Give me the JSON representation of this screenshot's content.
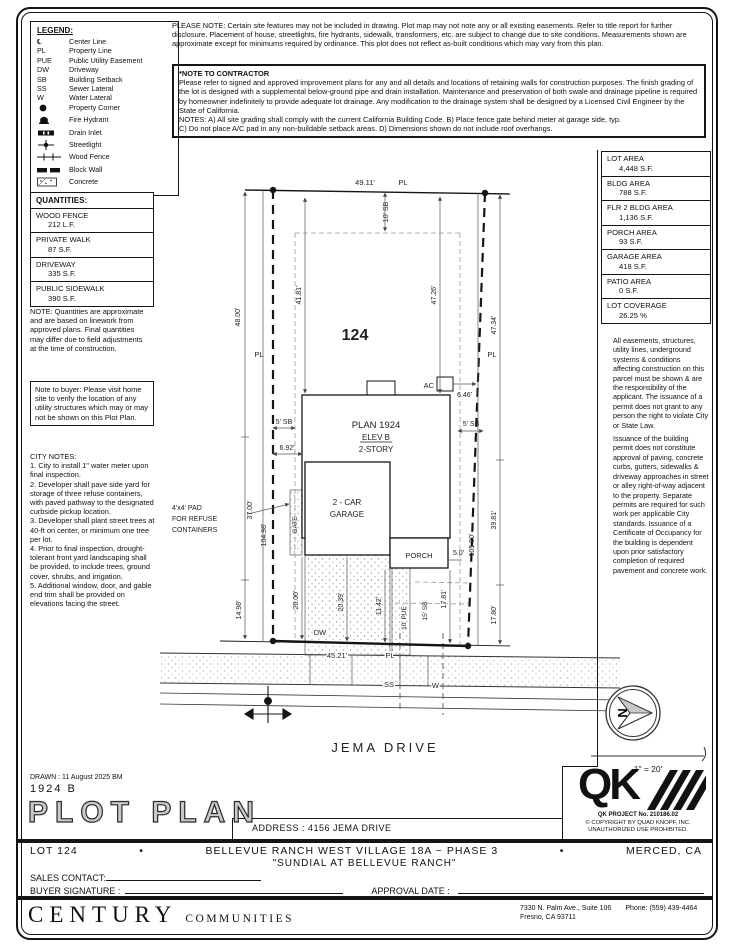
{
  "header": {
    "please_note": "PLEASE NOTE:  Certain site features may not be included in drawing. Plot map may not note any or all existing easements. Refer to title report for further disclosure. Placement of house, streetlights, fire hydrants, sidewalk, transformers, etc. are subject to change due to site conditions. Measurements shown are approximate except for minimums required by ordinance. This plot does not reflect as-built conditions which may vary from this plan.",
    "contractor_title": "*NOTE TO CONTRACTOR",
    "contractor_body": "Please refer to signed and approved improvement plans for any and all details and locations of retaining walls for construction purposes. The finish grading of the lot is designed with a supplemental below-ground pipe and drain installation. Maintenance and preservation of both swale and drainage pipeline is required by homeowner indefinitely to provide adequate lot drainage. Any modification to the drainage system shall be designed by a Licensed Civil Engineer by the State of California.\nNOTES:  A) All site grading shall comply with the current California Building Code.  B) Place fence gate behind meter at garage side, typ.\nC) Do not place A/C pad in any non-buildable setback areas.  D) Dimensions shown do not include roof overhangs."
  },
  "legend": {
    "title": "LEGEND:",
    "items": [
      {
        "sym": "℄",
        "label": "Center Line"
      },
      {
        "sym": "PL",
        "label": "Property Line"
      },
      {
        "sym": "PUE",
        "label": "Public Utility Easement"
      },
      {
        "sym": "DW",
        "label": "Driveway"
      },
      {
        "sym": "SB",
        "label": "Building Setback"
      },
      {
        "sym": "SS",
        "label": "Sewer Lateral"
      },
      {
        "sym": "W",
        "label": "Water Lateral"
      },
      {
        "icon": "property-corner",
        "label": "Property Corner"
      },
      {
        "icon": "fire-hydrant",
        "label": "Fire Hydrant"
      },
      {
        "icon": "drain-inlet",
        "label": "Drain Inlet"
      },
      {
        "icon": "streetlight",
        "label": "Streetlight"
      },
      {
        "icon": "wood-fence",
        "label": "Wood Fence"
      },
      {
        "icon": "block-wall",
        "label": "Block Wall"
      },
      {
        "icon": "concrete",
        "label": "Concrete"
      }
    ]
  },
  "quantities": {
    "title": "QUANTITIES:",
    "items": [
      {
        "label": "WOOD FENCE",
        "value": "212 L.F."
      },
      {
        "label": "PRIVATE WALK",
        "value": "87 S.F."
      },
      {
        "label": "DRIVEWAY",
        "value": "335 S.F."
      },
      {
        "label": "PUBLIC SIDEWALK",
        "value": "390 S.F."
      }
    ],
    "note": "NOTE: Quantities are approximate and are based on linework from approved plans.  Final quantities may differ due to field adjustments at the time of construction."
  },
  "buyer_note": "Note to buyer: Please visit home site to verify the location of any utility structures which may or may not be shown on this Plot Plan.",
  "city_notes": {
    "title": "CITY NOTES:",
    "body": "1. City to install 1\" water meter upon final inspection.\n2. Developer shall pave side yard for storage of three refuse containers, with paved pathway to the designated curbside pickup location.\n3. Developer shall plant street trees at 40-ft on center, or minimum one tree per lot.\n4. Prior to final inspection, drought-tolerant front yard landscaping shall be provided, to include trees, ground cover, shrubs, and irrigation.\n5. Additional window, door, and gable end trim shall be provided on elevations facing the street."
  },
  "areas": {
    "items": [
      {
        "label": "LOT AREA",
        "value": "4,448 S.F."
      },
      {
        "label": "BLDG AREA",
        "value": "788 S.F."
      },
      {
        "label": "FLR 2 BLDG AREA",
        "value": "1,136 S.F."
      },
      {
        "label": "PORCH AREA",
        "value": "93 S.F."
      },
      {
        "label": "GARAGE AREA",
        "value": "418 S.F."
      },
      {
        "label": "PATIO AREA",
        "value": "0 S.F."
      },
      {
        "label": "LOT COVERAGE",
        "value": "26.25 %"
      }
    ]
  },
  "side_notes": {
    "para1": "All easements, structures, utility lines, underground systems & conditions affecting construction on this parcel must be shown & are the responsibility of the applicant. The issuance of a permit does not grant to any person the right to violate City or State Law.",
    "para2": "Issuance of the building permit does not constitute approval of paving, concrete curbs, gutters, sidewalks & driveway approaches in street or alley right-of-way adjacent to the property. Separate permits are required for such work per applicable City standards. Issuance of a Certificate of Occupancy for the building is dependent upon prior satisfactory completion of required pavement and concrete work."
  },
  "plot": {
    "lot_number": "124",
    "plan": "PLAN 1924",
    "elev": "ELEV B",
    "story": "2-STORY",
    "garage1": "2 - CAR",
    "garage2": "GARAGE",
    "porch": "PORCH",
    "gate": "GATE",
    "ac": "AC",
    "dw": "DW",
    "ss": "SS",
    "w": "W",
    "pl": "PL",
    "street": "JEMA DRIVE",
    "refuse1": "4'x4' PAD",
    "refuse2": "FOR REFUSE",
    "refuse3": "CONTAINERS",
    "north": "N",
    "scale": "1\" = 20'",
    "dims": {
      "top": "49.11'",
      "top_sb": "10' SB",
      "left_outer": "48.00'",
      "house_left": "41.81'",
      "house_right": "47.26'",
      "right_outer": "47.34'",
      "left_mid": "37.00'",
      "left_full": "104.98'",
      "left_bot": "14.98'",
      "sb_left": "5' SB",
      "sb_right": "5' SB",
      "gap_left": "6.92'",
      "gap_ac": "6.46'",
      "drive_w": "20.00'",
      "drive_l": "20.39'",
      "walk": "11.42'",
      "pue": "10' PUE",
      "front_sb": "15' SB",
      "porch_depth": "17.81'",
      "right_bot": "17.80'",
      "right_full": "105.00'",
      "right_mid": "39.81'",
      "bottom": "45.21'",
      "porch_side": "5.0'"
    }
  },
  "qk": {
    "logo": "QK",
    "project": "QK PROJECT No. 210186.02",
    "copy1": "© COPYRIGHT BY QUAD KNOPF, INC.",
    "copy2": "UNAUTHORIZED USE PROHIBITED."
  },
  "titleblock": {
    "drawn": "DRAWN :  11 August 2025  BM",
    "plan_no": "1924  B",
    "title": "PLOT PLAN",
    "address": "ADDRESS :  4156 JEMA DRIVE"
  },
  "footer": {
    "lot": "LOT 124",
    "bullet": "•",
    "subdivision": "BELLEVUE RANCH WEST VILLAGE 18A ~ PHASE 3",
    "city": "MERCED, CA",
    "community": "\"SUNDIAL AT BELLEVUE RANCH\"",
    "sales_label": "SALES CONTACT:",
    "buyer_label": "BUYER SIGNATURE :",
    "approval_label": "APPROVAL DATE :"
  },
  "century": {
    "name": "CENTURY",
    "sub": "COMMUNITIES",
    "addr1": "7330 N. Palm Ave., Suite 106",
    "phone": "Phone:  (559) 439-4464",
    "addr2": "Fresno, CA  93711"
  }
}
